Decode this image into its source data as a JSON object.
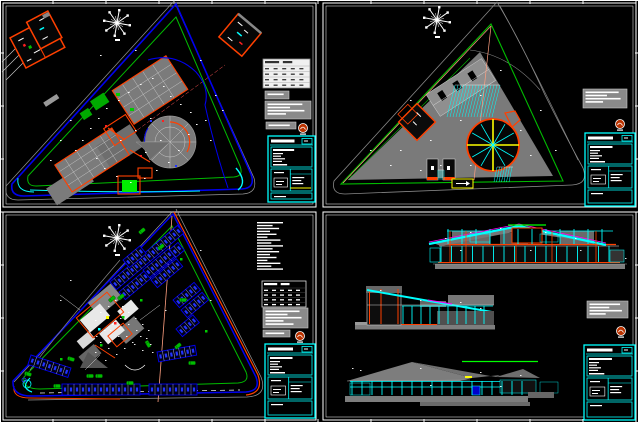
{
  "document": {
    "type": "cad-multi-sheet-drawing",
    "sheets": [
      {
        "id": "tl",
        "content": "site-plan-ground-floor"
      },
      {
        "id": "tr",
        "content": "site-plan-roof-paving"
      },
      {
        "id": "bl",
        "content": "site-plan-parking-landscape"
      },
      {
        "id": "br",
        "content": "sections-elevations"
      }
    ]
  },
  "palette": {
    "background": "#000000",
    "white": "#ffffff",
    "gray": "#7d7d7d",
    "dark_gray": "#4f4f4f",
    "blue": "#0000ee",
    "glyph_blue": "#2233ff",
    "green": "#00bb00",
    "bright_green": "#00ff00",
    "cyan": "#00ffff",
    "orange": "#ff4000",
    "red": "#ff2020",
    "yellow": "#ffff00",
    "magenta": "#ff00ff",
    "salmon": "#ff9f80",
    "stamp": "#bb3300",
    "table_light": "#f0f0f0",
    "notes_gray": "#8a8a8a"
  },
  "frame": {
    "tick_spacing": 53
  },
  "gen": [
    {
      "type": "compass",
      "layer": "tl",
      "x": 117,
      "y": 23,
      "r": 13
    },
    {
      "type": "compass",
      "layer": "tr",
      "x": 437,
      "y": 20,
      "r": 13
    },
    {
      "type": "compass",
      "layer": "bl",
      "x": 117,
      "y": 238,
      "r": 13
    },
    {
      "type": "hatch",
      "layer": "tr",
      "x": 455,
      "y": 85,
      "w": 45,
      "h": 32,
      "step": 3,
      "slant": -8
    },
    {
      "type": "hatch",
      "layer": "tr",
      "x": 497,
      "y": 167,
      "w": 16,
      "h": 15,
      "step": 2.5,
      "slant": -3
    },
    {
      "type": "hatch",
      "layer": "tr",
      "x": 438,
      "y": 170,
      "w": 6,
      "h": 10,
      "step": 2,
      "slant": 0
    },
    {
      "type": "spokes",
      "layer": "tr",
      "cx": 493,
      "cy": 145,
      "r": 26
    },
    {
      "type": "parking",
      "layer": "bl",
      "x": 110,
      "y": 282,
      "a": -40,
      "n": 16,
      "sw": 5.5,
      "sh": 10
    },
    {
      "type": "parking",
      "layer": "bl",
      "x": 119,
      "y": 292,
      "a": -40,
      "n": 14,
      "sw": 5.5,
      "sh": 10
    },
    {
      "type": "parking",
      "layer": "bl",
      "x": 143,
      "y": 270,
      "a": -40,
      "n": 6,
      "sw": 5.5,
      "sh": 10
    },
    {
      "type": "parking",
      "layer": "bl",
      "x": 151,
      "y": 280,
      "a": -40,
      "n": 6,
      "sw": 5.5,
      "sh": 10
    },
    {
      "type": "parking",
      "layer": "bl",
      "x": 173,
      "y": 300,
      "a": -40,
      "n": 5,
      "sw": 5.5,
      "sh": 10
    },
    {
      "type": "parking",
      "layer": "bl",
      "x": 181,
      "y": 310,
      "a": -40,
      "n": 5,
      "sw": 5.5,
      "sh": 10
    },
    {
      "type": "parking",
      "layer": "bl",
      "x": 176,
      "y": 329,
      "a": -40,
      "n": 4,
      "sw": 5.5,
      "sh": 10
    },
    {
      "type": "parking",
      "layer": "bl",
      "x": 157,
      "y": 352,
      "a": -10,
      "n": 7,
      "sw": 5.5,
      "sh": 10
    },
    {
      "type": "parking",
      "layer": "bl",
      "x": 62,
      "y": 384,
      "a": 0,
      "n": 13,
      "sw": 6,
      "sh": 11
    },
    {
      "type": "parking",
      "layer": "bl",
      "x": 149,
      "y": 384,
      "a": 0,
      "n": 8,
      "sw": 6,
      "sh": 11
    },
    {
      "type": "parking",
      "layer": "bl",
      "x": 31,
      "y": 355,
      "a": 18,
      "n": 7,
      "sw": 6,
      "sh": 10
    },
    {
      "type": "parking",
      "layer": "bl",
      "x": 123,
      "y": 260,
      "a": -40,
      "n": 4,
      "sw": 5.5,
      "sh": 10
    },
    {
      "type": "car",
      "layer": "bl",
      "pts": [
        [
          121,
          297,
          -40
        ],
        [
          183,
          300,
          0
        ],
        [
          148,
          344,
          60
        ],
        [
          178,
          346,
          -40
        ],
        [
          192,
          363,
          0
        ],
        [
          28,
          374,
          18
        ],
        [
          90,
          376,
          0
        ],
        [
          99,
          376,
          0
        ],
        [
          142,
          231,
          -40
        ],
        [
          161,
          247,
          -40
        ],
        [
          71,
          359,
          18
        ],
        [
          112,
          299,
          -40
        ],
        [
          130,
          383,
          0
        ],
        [
          57,
          386,
          0
        ]
      ]
    },
    {
      "type": "colonnade",
      "layer": "br",
      "x1": 441,
      "x2": 616,
      "y": 246,
      "h": 16,
      "step": 10.5,
      "color": "#00ffff"
    },
    {
      "type": "colonnade",
      "layer": "br",
      "x1": 448,
      "x2": 612,
      "y": 229,
      "h": 15,
      "step": 14,
      "color": "#00ffff"
    },
    {
      "type": "colonnade",
      "layer": "br",
      "x1": 403,
      "x2": 492,
      "y": 306,
      "h": 18,
      "step": 9,
      "color": "#00ffff"
    },
    {
      "type": "colonnade",
      "layer": "br",
      "x1": 352,
      "x2": 528,
      "y": 381,
      "h": 14,
      "step": 10,
      "color": "#00ffff"
    },
    {
      "type": "specks",
      "layer": "tl",
      "color": "#ffffff",
      "s": 1.6,
      "points": [
        [
          75,
          150
        ],
        [
          82,
          140
        ],
        [
          90,
          128
        ],
        [
          98,
          118
        ],
        [
          106,
          108
        ],
        [
          118,
          100
        ],
        [
          128,
          92
        ],
        [
          140,
          84
        ],
        [
          152,
          78
        ],
        [
          163,
          86
        ],
        [
          170,
          96
        ],
        [
          180,
          104
        ],
        [
          190,
          112
        ],
        [
          196,
          124
        ],
        [
          188,
          134
        ],
        [
          178,
          150
        ],
        [
          168,
          162
        ],
        [
          156,
          170
        ],
        [
          144,
          178
        ],
        [
          130,
          182
        ],
        [
          116,
          176
        ],
        [
          104,
          168
        ],
        [
          96,
          158
        ],
        [
          120,
          140
        ],
        [
          135,
          130
        ],
        [
          150,
          118
        ],
        [
          160,
          140
        ],
        [
          145,
          152
        ],
        [
          205,
          120
        ],
        [
          210,
          140
        ],
        [
          70,
          120
        ],
        [
          60,
          140
        ],
        [
          215,
          95
        ],
        [
          222,
          110
        ],
        [
          50,
          160
        ],
        [
          100,
          55
        ],
        [
          135,
          50
        ],
        [
          200,
          60
        ]
      ]
    },
    {
      "type": "specks",
      "layer": "tr",
      "color": "#ffffff",
      "s": 1.6,
      "points": [
        [
          400,
          150
        ],
        [
          430,
          140
        ],
        [
          460,
          120
        ],
        [
          410,
          100
        ],
        [
          480,
          95
        ],
        [
          520,
          130
        ],
        [
          530,
          155
        ],
        [
          470,
          165
        ],
        [
          440,
          165
        ],
        [
          390,
          165
        ],
        [
          540,
          110
        ],
        [
          500,
          70
        ],
        [
          370,
          150
        ],
        [
          420,
          170
        ],
        [
          555,
          150
        ]
      ]
    },
    {
      "type": "specks",
      "layer": "bl",
      "color": "#ffffff",
      "s": 1.5,
      "points": [
        [
          90,
          330
        ],
        [
          95,
          320
        ],
        [
          100,
          312
        ],
        [
          108,
          306
        ],
        [
          115,
          300
        ],
        [
          122,
          306
        ],
        [
          128,
          312
        ],
        [
          135,
          318
        ],
        [
          142,
          324
        ],
        [
          148,
          330
        ],
        [
          140,
          336
        ],
        [
          132,
          342
        ],
        [
          124,
          348
        ],
        [
          116,
          354
        ],
        [
          108,
          348
        ],
        [
          100,
          342
        ],
        [
          96,
          336
        ],
        [
          104,
          330
        ],
        [
          112,
          324
        ],
        [
          120,
          318
        ],
        [
          128,
          324
        ],
        [
          136,
          330
        ],
        [
          118,
          336
        ],
        [
          110,
          330
        ],
        [
          126,
          336
        ],
        [
          134,
          344
        ],
        [
          142,
          350
        ],
        [
          150,
          344
        ],
        [
          105,
          360
        ],
        [
          95,
          352
        ],
        [
          146,
          338
        ],
        [
          152,
          352
        ],
        [
          60,
          300
        ],
        [
          70,
          280
        ],
        [
          200,
          250
        ],
        [
          210,
          300
        ],
        [
          165,
          310
        ]
      ]
    },
    {
      "type": "specks",
      "layer": "br",
      "color": "#ffffff",
      "s": 1.5,
      "points": [
        [
          445,
          238
        ],
        [
          470,
          232
        ],
        [
          500,
          228
        ],
        [
          545,
          232
        ],
        [
          575,
          238
        ],
        [
          460,
          250
        ],
        [
          530,
          250
        ],
        [
          580,
          250
        ],
        [
          380,
          290
        ],
        [
          420,
          300
        ],
        [
          460,
          302
        ],
        [
          480,
          308
        ],
        [
          360,
          370
        ],
        [
          420,
          368
        ],
        [
          480,
          372
        ],
        [
          520,
          375
        ],
        [
          430,
          385
        ],
        [
          500,
          386
        ],
        [
          352,
          368
        ],
        [
          625,
          258
        ]
      ]
    },
    {
      "type": "notesbox",
      "layer": "tl",
      "x": 265,
      "y": 91,
      "w": 24,
      "h": 8
    },
    {
      "type": "notesbox",
      "layer": "tl",
      "x": 265,
      "y": 101,
      "w": 46,
      "h": 18
    },
    {
      "type": "notesbox",
      "layer": "tl",
      "x": 266,
      "y": 122,
      "w": 30,
      "h": 7
    },
    {
      "type": "notesbox",
      "layer": "tr",
      "x": 583,
      "y": 89,
      "w": 44,
      "h": 19
    },
    {
      "type": "notesbox",
      "layer": "bl",
      "x": 263,
      "y": 308,
      "w": 45,
      "h": 20
    },
    {
      "type": "notesbox",
      "layer": "bl",
      "x": 263,
      "y": 330,
      "w": 27,
      "h": 7
    },
    {
      "type": "notesbox",
      "layer": "br",
      "x": 587,
      "y": 301,
      "w": 41,
      "h": 17
    },
    {
      "type": "textblock",
      "layer": "bl",
      "x": 257,
      "y": 222,
      "n": 17,
      "maxw": 26
    },
    {
      "type": "table",
      "layer": "tl",
      "x": 263,
      "y": 59,
      "w": 47,
      "h": 29,
      "rows": 4,
      "style": "light"
    },
    {
      "type": "table",
      "layer": "bl",
      "x": 262,
      "y": 281,
      "w": 44,
      "h": 26,
      "rows": 4,
      "style": "dark"
    },
    {
      "type": "titleblock",
      "layer": "tl",
      "x": 268,
      "y": 136,
      "w": 47,
      "h": 66,
      "yellow": true
    },
    {
      "type": "titleblock",
      "layer": "tr",
      "x": 585,
      "y": 133,
      "w": 50,
      "h": 73,
      "yellow": false
    },
    {
      "type": "titleblock",
      "layer": "bl",
      "x": 265,
      "y": 344,
      "w": 50,
      "h": 74,
      "yellow": false
    },
    {
      "type": "titleblock",
      "layer": "br",
      "x": 584,
      "y": 345,
      "w": 51,
      "h": 75,
      "yellow": false
    },
    {
      "type": "stamp",
      "layer": "tl",
      "x": 303,
      "y": 128
    },
    {
      "type": "stamp",
      "layer": "tr",
      "x": 620,
      "y": 124
    },
    {
      "type": "stamp",
      "layer": "bl",
      "x": 300,
      "y": 336
    },
    {
      "type": "stamp",
      "layer": "br",
      "x": 621,
      "y": 331
    }
  ]
}
